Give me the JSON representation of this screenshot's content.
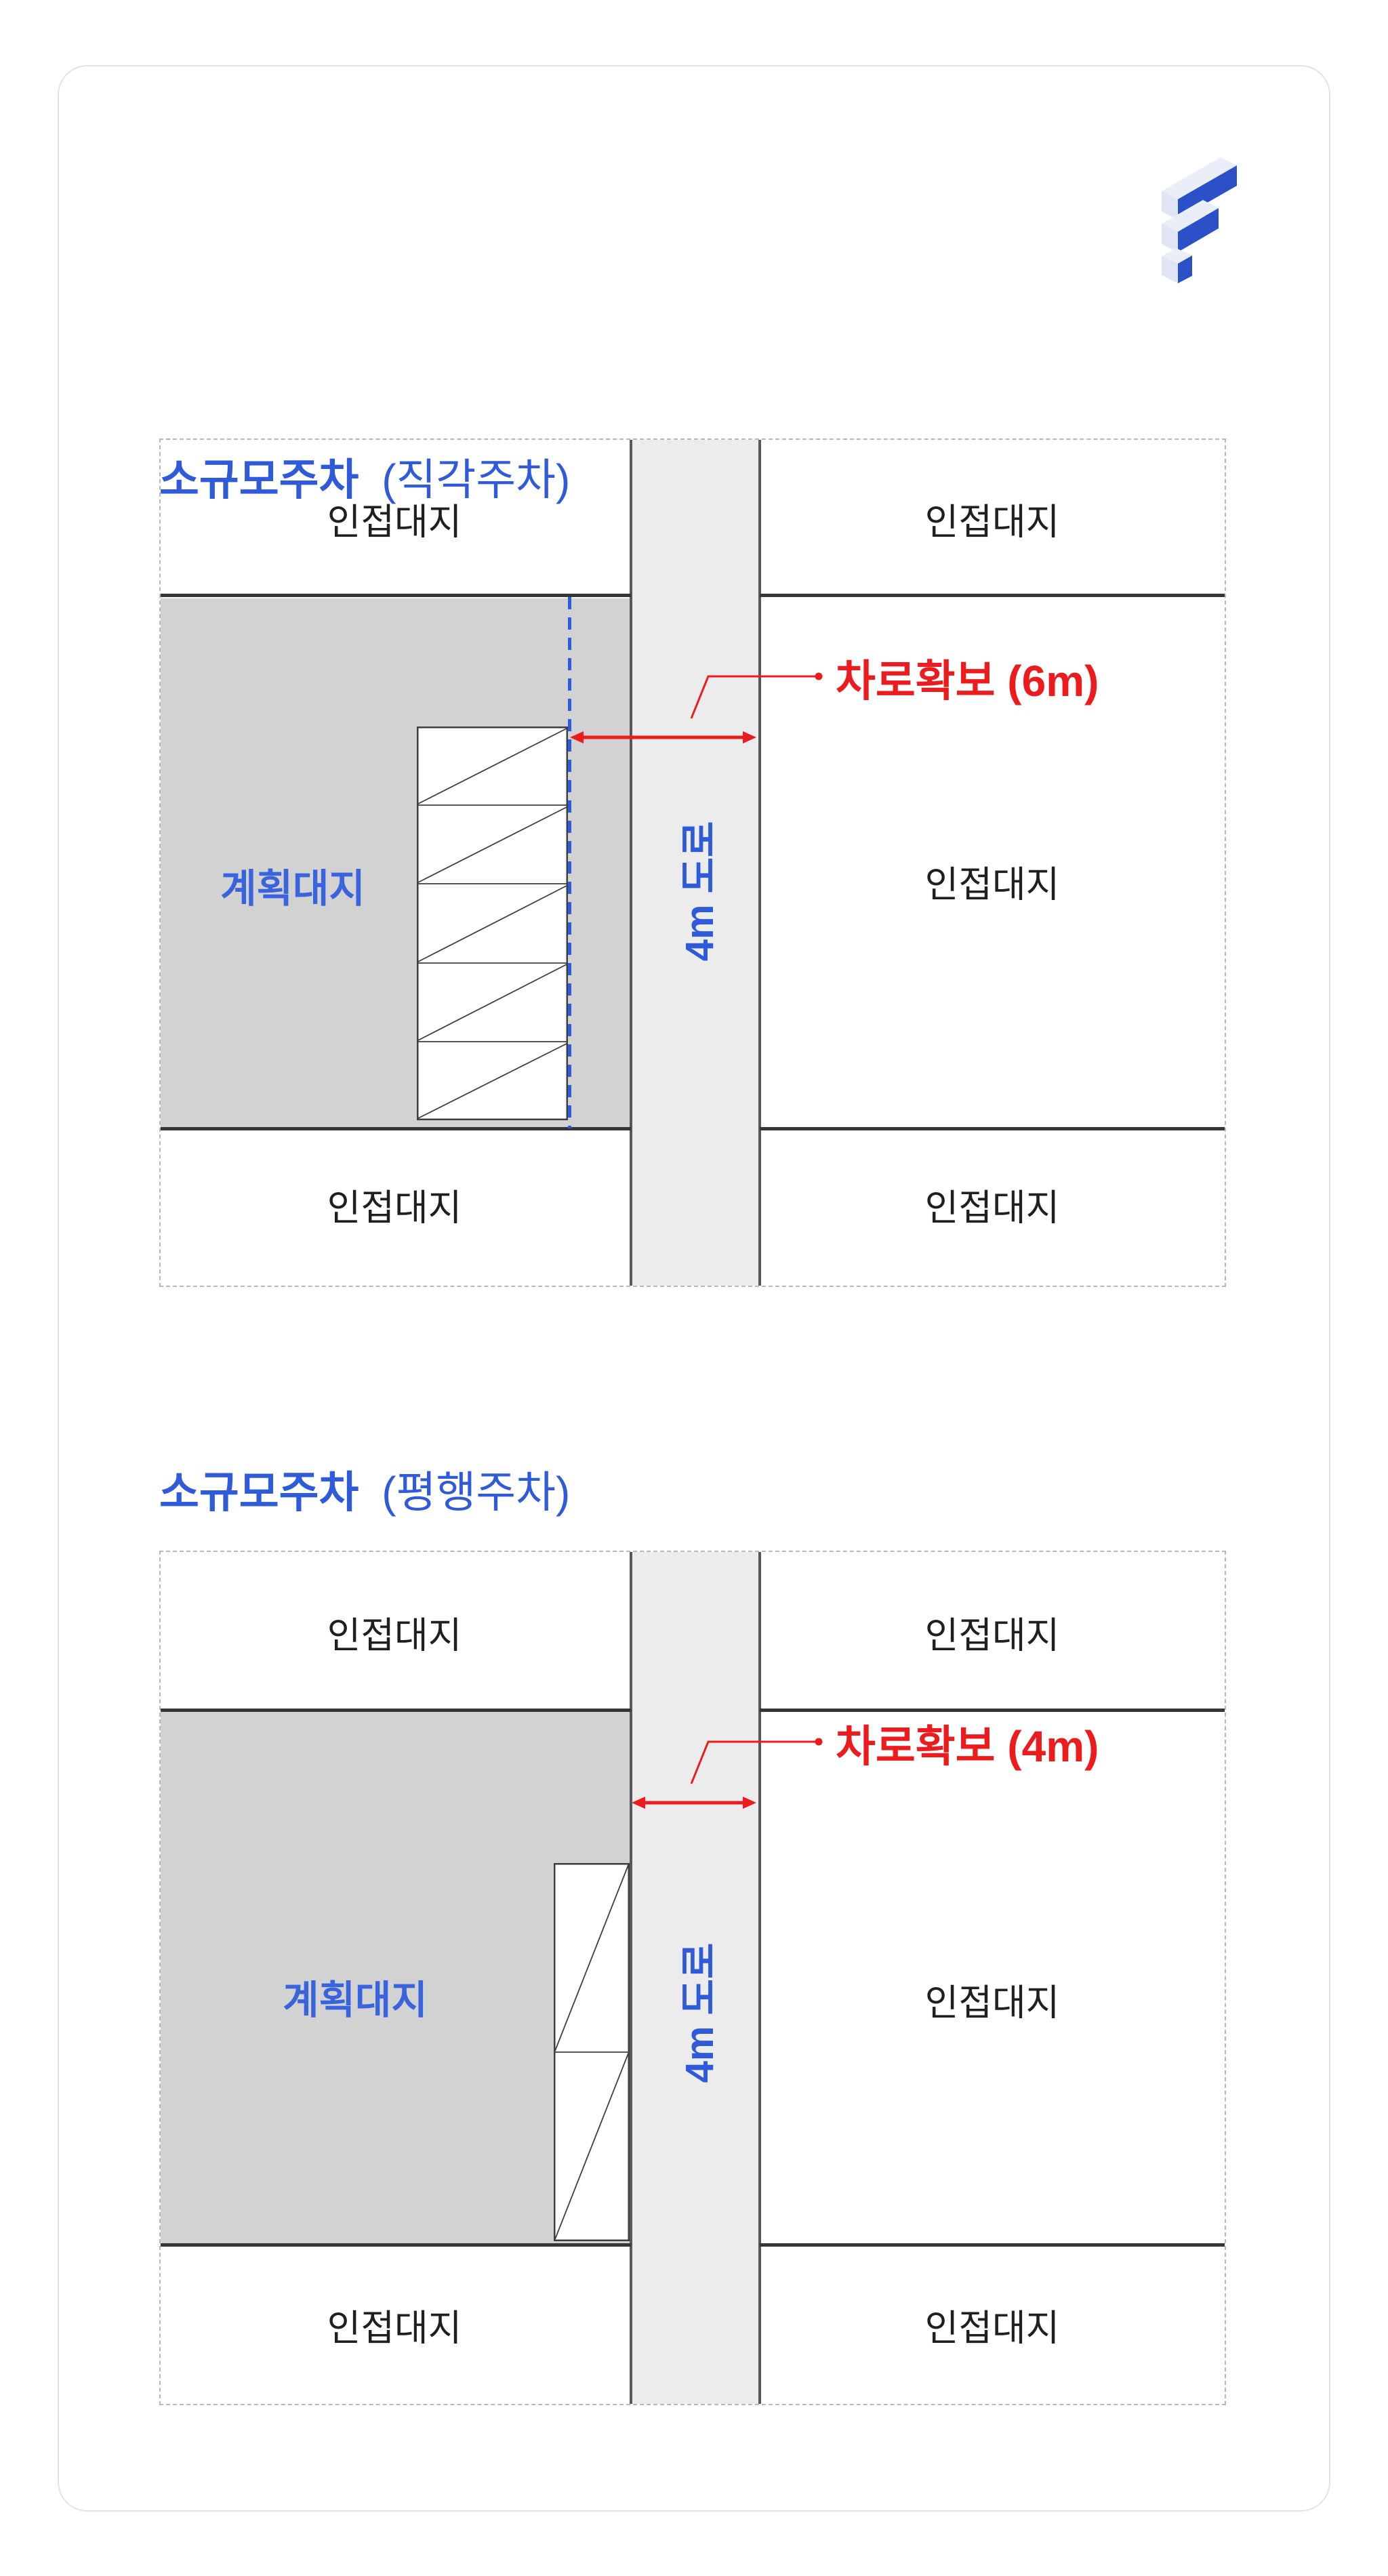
{
  "logo": {
    "name": "isometric-f-logo"
  },
  "sections": [
    {
      "title_main": "소규모주차",
      "title_sub": "(직각주차)",
      "labels": {
        "adjacent": "인접대지",
        "planned": "계획대지",
        "road": "4m 도로",
        "lane": "차로확보 (6m)"
      },
      "stall_count": 5
    },
    {
      "title_main": "소규모주차",
      "title_sub": "(평행주차)",
      "labels": {
        "adjacent": "인접대지",
        "planned": "계획대지",
        "road": "4m 도로",
        "lane": "차로확보 (4m)"
      },
      "stall_count": 2
    }
  ],
  "colors": {
    "accent-blue": "#2F5BDB",
    "label-blue": "#3A63DE",
    "accent-red": "#EC1B1E",
    "site-gray": "#D2D2D3",
    "road-gray": "#ECECED",
    "line-dark": "#35353A",
    "road-border": "#58585C",
    "stall-border": "#3F3F42",
    "dash-border": "#B8B8B8",
    "blue-dash": "#2A5BE0",
    "text-dark": "#1F1F1F",
    "logo-blue": "#2B50C8",
    "logo-light-top": "#EAEEF9",
    "logo-light-side": "#DFE5F5"
  }
}
